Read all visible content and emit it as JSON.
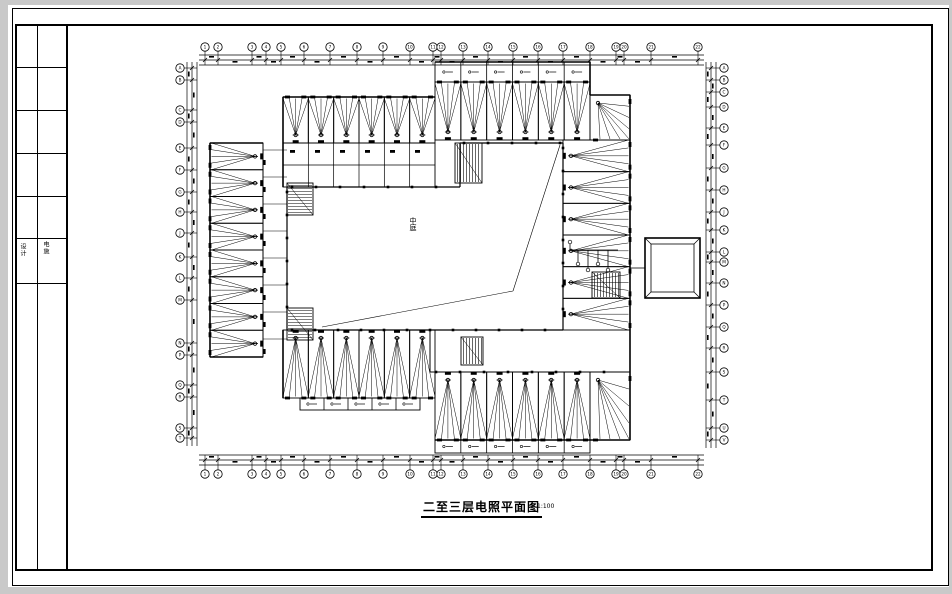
{
  "sheet": {
    "background_color": "#c9c9c9",
    "paper_color": "#ffffff",
    "ink_color": "#000000",
    "title": "二至三层电照平面图",
    "scale_note": "1:100",
    "courtyard_label": "中庭",
    "title_block": {
      "col1_text": "设计",
      "col2_text": "电施",
      "divider_ys": [
        67,
        110,
        153,
        196,
        238,
        283
      ]
    }
  },
  "axes": {
    "top": {
      "bubble_y": 47,
      "line_ys": [
        55,
        60,
        65
      ],
      "x": [
        205,
        218,
        252,
        266,
        281,
        304,
        330,
        357,
        383,
        410,
        433,
        441,
        463,
        488,
        513,
        538,
        563,
        590,
        616,
        624,
        651,
        698
      ],
      "labels": [
        "1",
        "2",
        "3",
        "4",
        "5",
        "6",
        "7",
        "8",
        "9",
        "10",
        "11",
        "12",
        "13",
        "14",
        "15",
        "16",
        "17",
        "18",
        "19",
        "20",
        "21",
        "22"
      ]
    },
    "bottom": {
      "bubble_y": 474,
      "line_ys": [
        455,
        460,
        465
      ],
      "x": [
        205,
        218,
        252,
        266,
        281,
        304,
        330,
        357,
        383,
        410,
        433,
        441,
        463,
        488,
        513,
        538,
        563,
        590,
        616,
        624,
        651,
        698
      ],
      "labels": [
        "1",
        "2",
        "3",
        "4",
        "5",
        "6",
        "7",
        "8",
        "9",
        "10",
        "11",
        "12",
        "13",
        "14",
        "15",
        "16",
        "17",
        "18",
        "19",
        "20",
        "21",
        "22"
      ]
    },
    "left": {
      "bubble_x": 180,
      "line_xs": [
        187,
        192,
        197
      ],
      "y": [
        68,
        80,
        110,
        122,
        148,
        170,
        192,
        212,
        233,
        257,
        278,
        300,
        343,
        355,
        385,
        397,
        428,
        438
      ],
      "labels": [
        "A",
        "B",
        "C",
        "D",
        "E",
        "F",
        "G",
        "H",
        "J",
        "K",
        "L",
        "M",
        "N",
        "P",
        "Q",
        "R",
        "S",
        "T"
      ]
    },
    "right": {
      "bubble_x": 724,
      "line_xs": [
        706,
        711,
        716
      ],
      "y": [
        68,
        80,
        92,
        107,
        128,
        145,
        168,
        190,
        212,
        230,
        252,
        262,
        283,
        305,
        327,
        348,
        372,
        400,
        428,
        440
      ],
      "labels": [
        "A",
        "B",
        "C",
        "D",
        "E",
        "F",
        "G",
        "H",
        "J",
        "K",
        "L",
        "M",
        "N",
        "P",
        "Q",
        "R",
        "S",
        "T",
        "U",
        "V"
      ]
    }
  }
}
